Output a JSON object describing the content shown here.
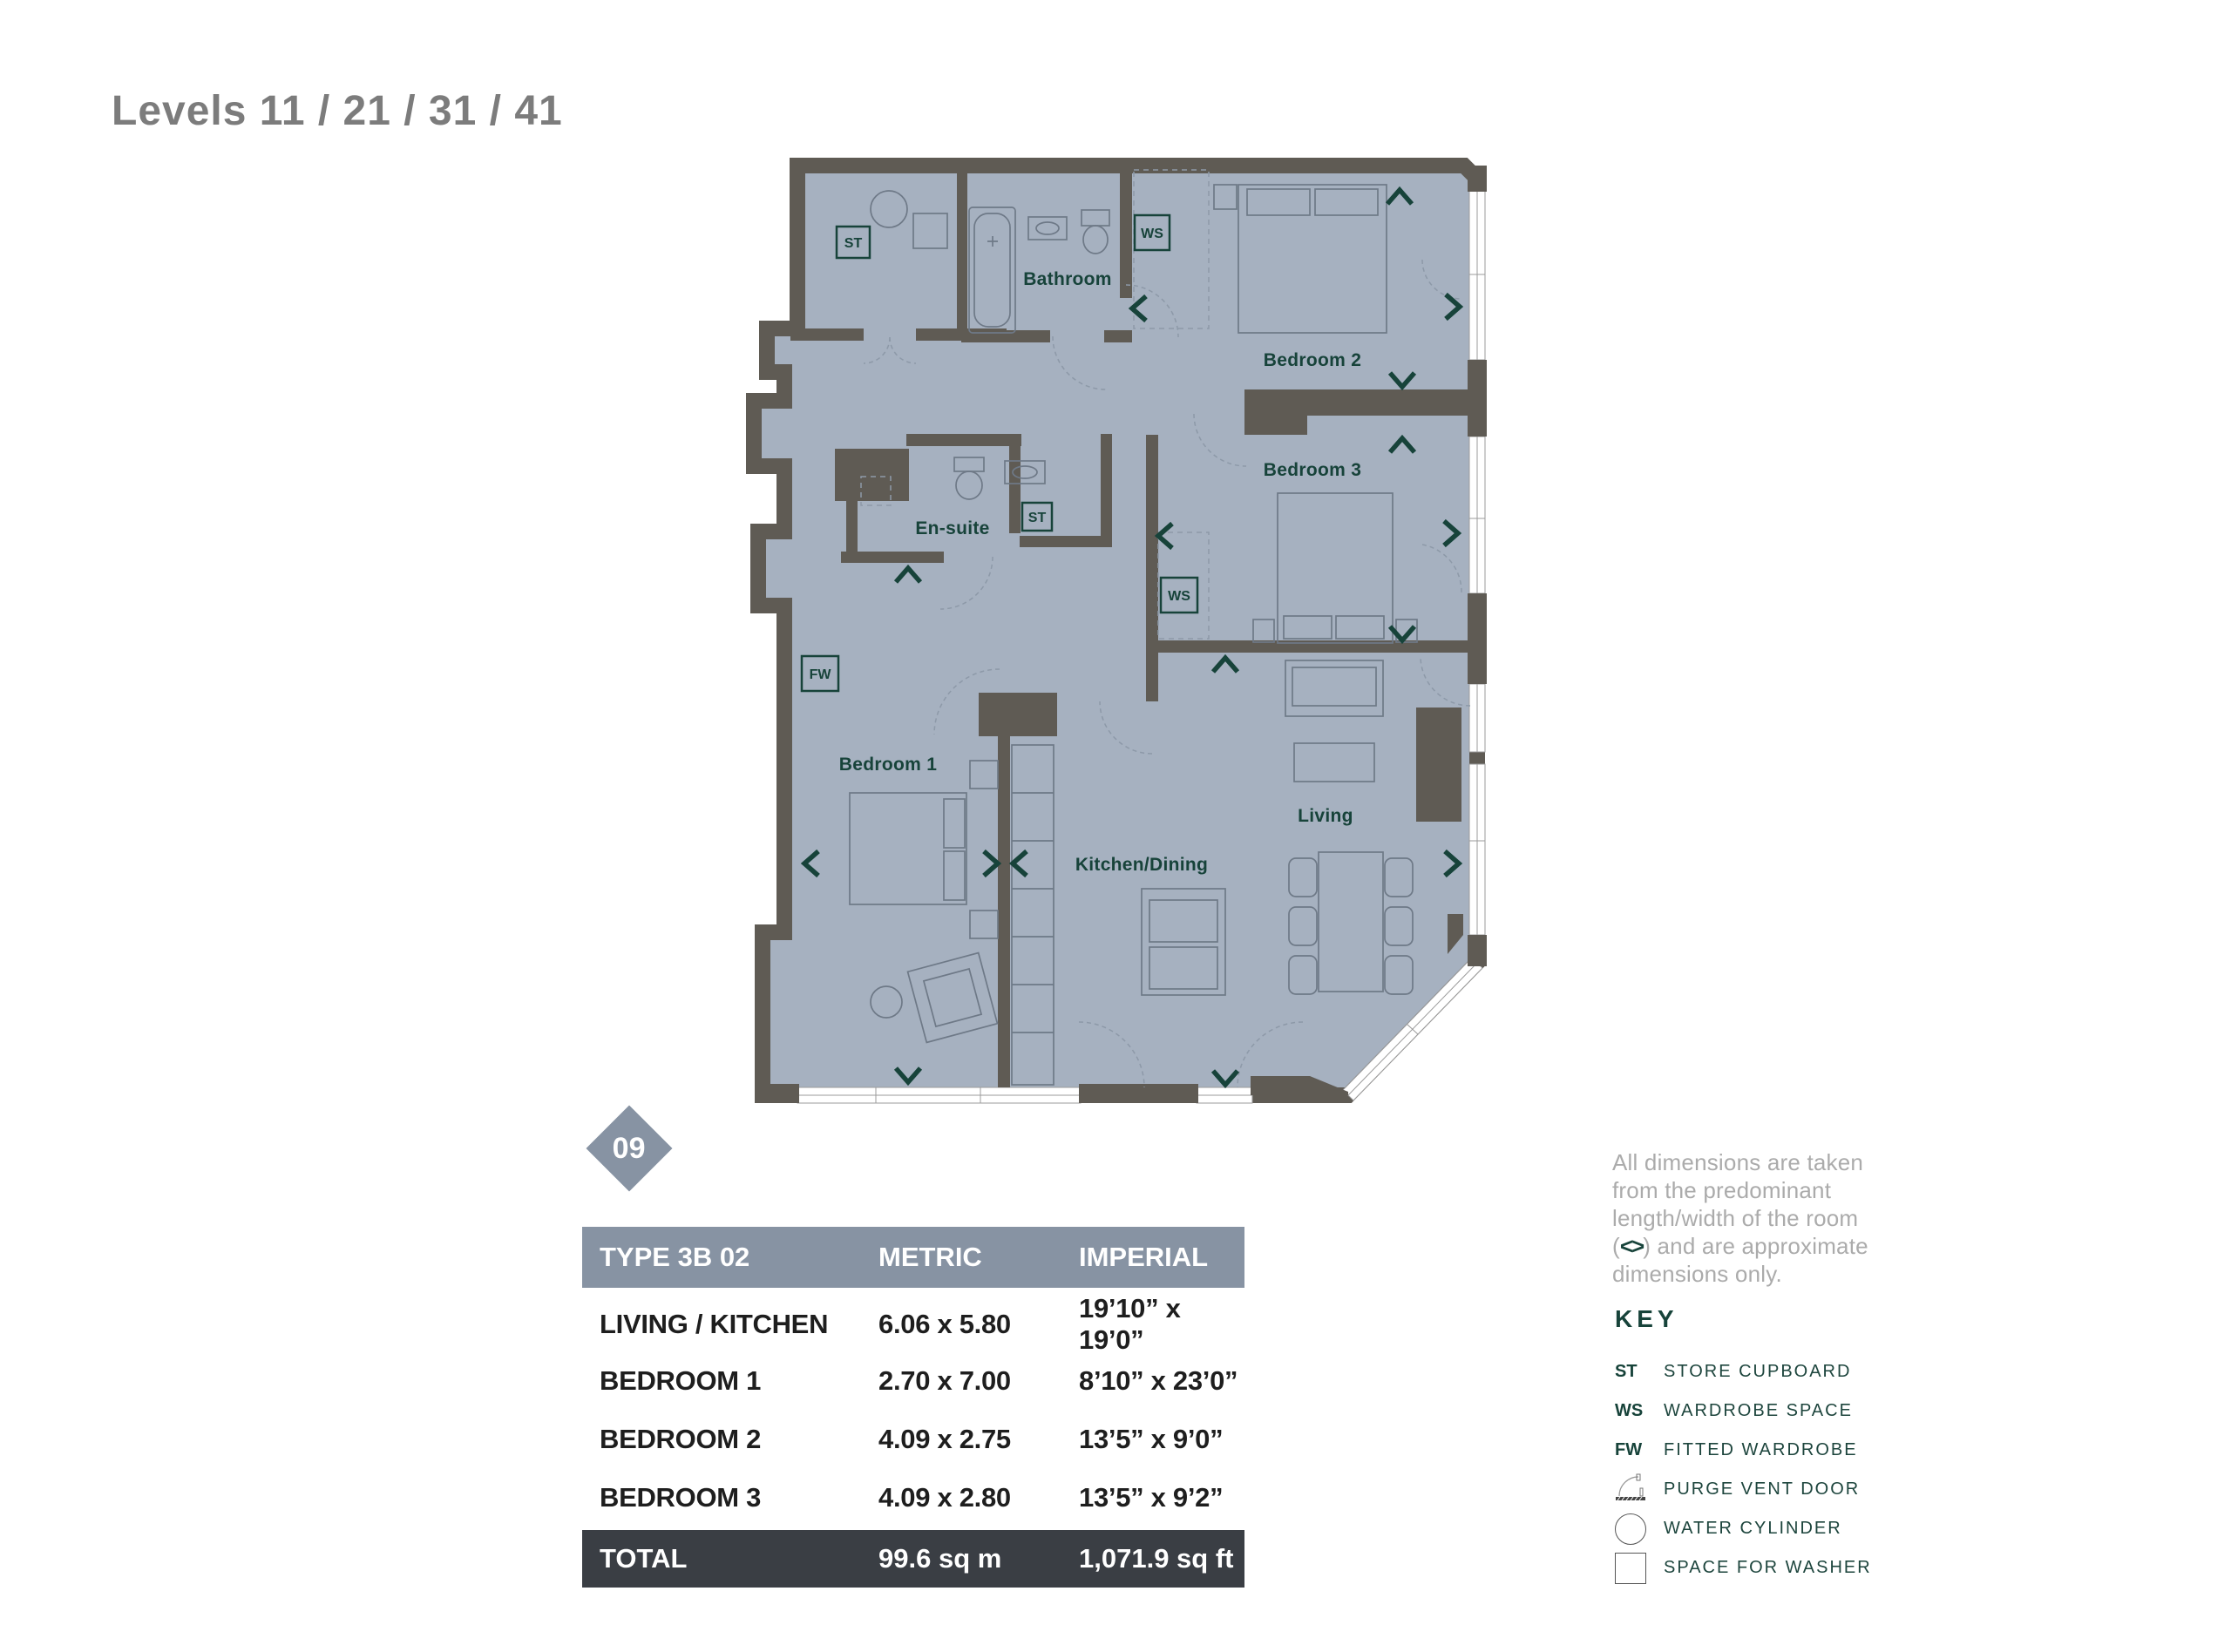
{
  "page": {
    "title": "Levels 11 / 21 / 31 / 41"
  },
  "plan": {
    "unit_badge": "09",
    "room_labels": {
      "bathroom": "Bathroom",
      "bedroom2": "Bedroom 2",
      "bedroom3": "Bedroom 3",
      "ensuite": "En-suite",
      "bedroom1": "Bedroom 1",
      "kitchen_dining": "Kitchen/Dining",
      "living": "Living"
    },
    "markers": {
      "st_utility": "ST",
      "st_hall": "ST",
      "ws_bedroom2": "WS",
      "ws_bedroom3": "WS",
      "fw_bedroom1": "FW"
    }
  },
  "table": {
    "header": {
      "type_label": "TYPE 3B 02",
      "metric_label": "METRIC",
      "imperial_label": "IMPERIAL"
    },
    "rows": [
      {
        "room": "LIVING / KITCHEN",
        "metric": "6.06 x 5.80",
        "imperial": "19’10” x 19’0”"
      },
      {
        "room": "BEDROOM 1",
        "metric": "2.70 x 7.00",
        "imperial": "8’10” x 23’0”"
      },
      {
        "room": "BEDROOM 2",
        "metric": "4.09 x 2.75",
        "imperial": "13’5” x 9’0”"
      },
      {
        "room": "BEDROOM 3",
        "metric": "4.09 x 2.80",
        "imperial": "13’5” x 9’2”"
      }
    ],
    "total": {
      "label": "TOTAL",
      "metric": "99.6 sq m",
      "imperial": "1,071.9 sq ft"
    }
  },
  "notes": {
    "disclaimer_before": "All dimensions are taken from the predominant length/width of the room (",
    "disclaimer_symbol": "<>",
    "disclaimer_after": ") and are approximate dimensions only."
  },
  "key": {
    "heading": "KEY",
    "items": [
      {
        "symbol": "ST",
        "label": "STORE CUPBOARD"
      },
      {
        "symbol": "WS",
        "label": "WARDROBE SPACE"
      },
      {
        "symbol": "FW",
        "label": "FITTED WARDROBE"
      },
      {
        "symbol": "purge-vent-door-icon",
        "label": "PURGE VENT DOOR"
      },
      {
        "symbol": "water-cylinder-icon",
        "label": "WATER CYLINDER"
      },
      {
        "symbol": "space-for-washer-icon",
        "label": "SPACE FOR WASHER"
      }
    ]
  },
  "colors": {
    "floor": "#a6b1c0",
    "wall": "#5f5b54",
    "accent_teal": "#17433a",
    "table_header_bg": "#8793a3",
    "total_row_bg": "#3a3e44",
    "title_gray": "#7c7c7c",
    "note_gray": "#ababab"
  }
}
